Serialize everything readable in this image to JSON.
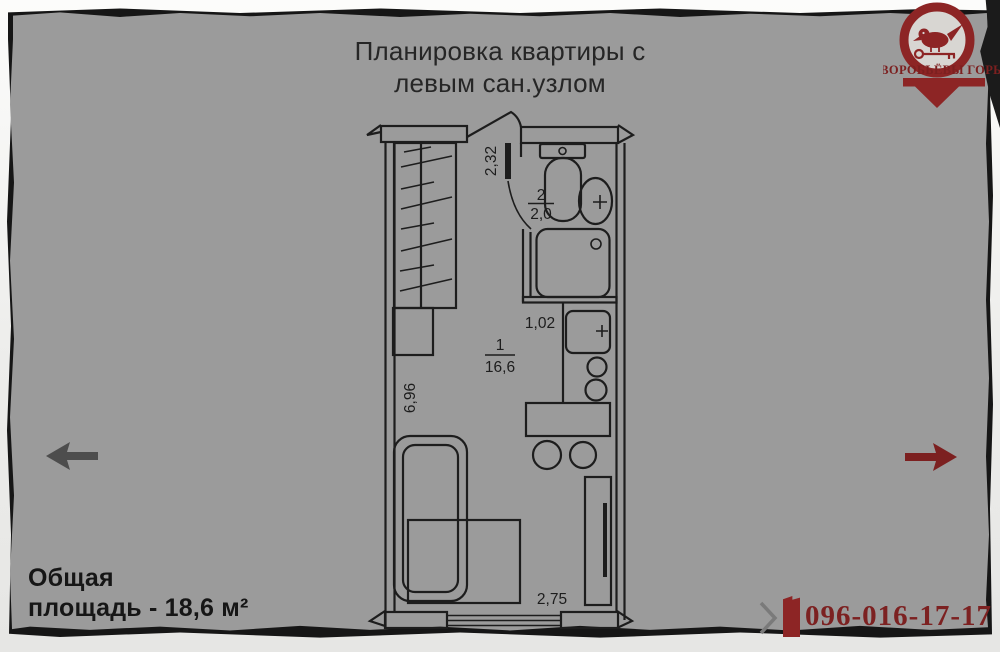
{
  "slide": {
    "title_line1": "Планировка квартиры с",
    "title_line2": "левым сан.узлом"
  },
  "logo": {
    "name": "ВОРОБЬЁВЫ ГОРЫ",
    "icon": "sparrow-on-key-pin"
  },
  "floorplan": {
    "main_room": {
      "number": "1",
      "area": "16,6"
    },
    "bathroom": {
      "number": "2",
      "area": "2,0"
    },
    "dims": {
      "hall_width": "2,32",
      "kitchen_width": "1,02",
      "room_length": "6,96",
      "room_width": "2,75"
    }
  },
  "footer": {
    "area_line1": "Общая",
    "area_line2": "площадь - 18,6 м²",
    "phone": "096-016-17-17"
  },
  "nav": {
    "prev_icon": "arrow-left-icon",
    "next_icon": "arrow-right-icon"
  },
  "colors": {
    "background": "#9b9b9b",
    "plan_line": "#1d1d1d",
    "accent_red": "#8d2525",
    "arrow_gray": "#4d4d4d",
    "paper": "#f1f1f0"
  }
}
